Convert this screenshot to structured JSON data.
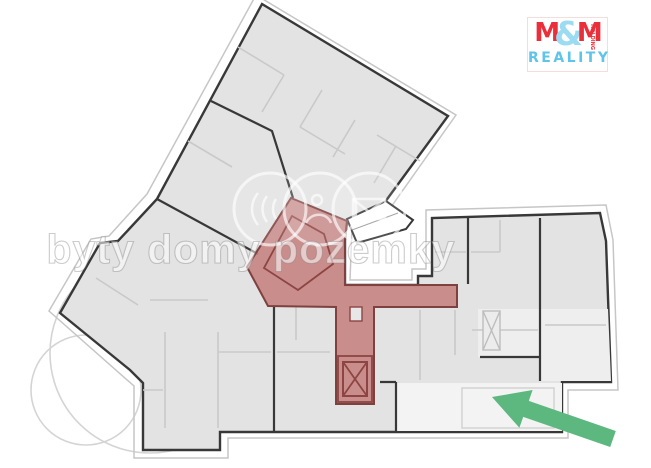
{
  "watermark": {
    "text": "byty domy pozemky"
  },
  "logo": {
    "m_left": "M",
    "ampersand": "&",
    "m_right": "M",
    "reality": "REALITY",
    "holding": "HOLDING"
  },
  "colors": {
    "highlight_fill": "#c5827f",
    "highlight_line": "#8d4543",
    "wall": "#383838",
    "building_fill": "#e3e3e3",
    "light_room": "#f3f3f3",
    "partition": "#c9c9c9",
    "site_line": "#c6c6c6",
    "arrow": "#5cb87e",
    "logo_red": "#ea2f3b",
    "logo_blue": "#9bdcf3"
  }
}
